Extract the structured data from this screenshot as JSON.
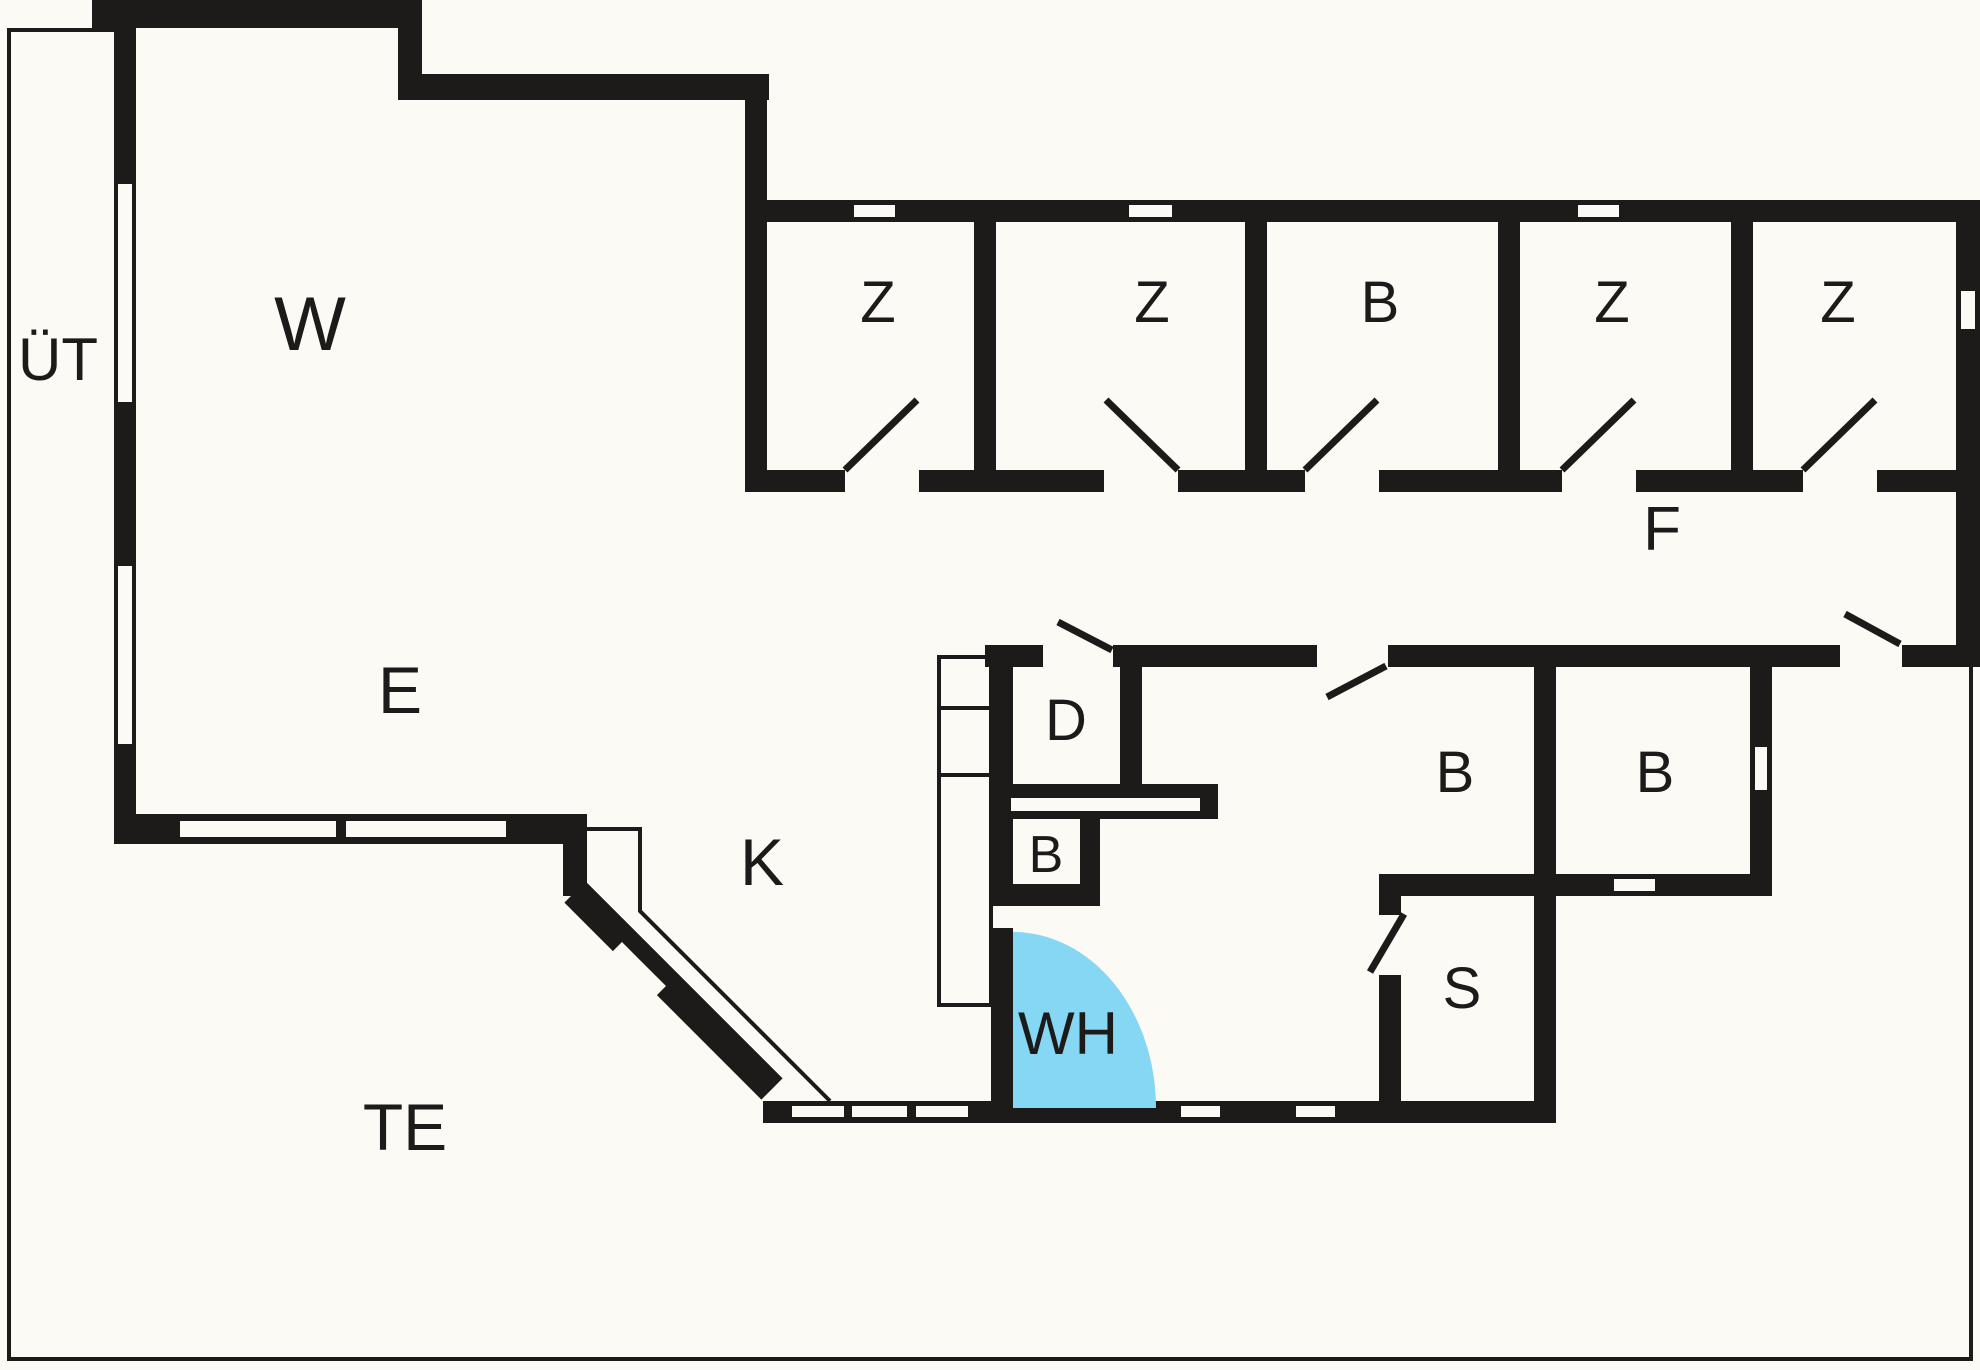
{
  "diagram": {
    "type": "floor-plan",
    "colors": {
      "wall": "#1d1b19",
      "background": "#fbfaf5",
      "window": "#fbfaf5",
      "door_swing_area": "#85d7f3"
    }
  },
  "rooms": {
    "ut": {
      "label": "ÜT"
    },
    "w": {
      "label": "W"
    },
    "e": {
      "label": "E"
    },
    "k": {
      "label": "K"
    },
    "te": {
      "label": "TE"
    },
    "f": {
      "label": "F"
    },
    "z1": {
      "label": "Z"
    },
    "z2": {
      "label": "Z"
    },
    "b_top": {
      "label": "B"
    },
    "z4": {
      "label": "Z"
    },
    "z5": {
      "label": "Z"
    },
    "d": {
      "label": "D"
    },
    "wc": {
      "label": "B"
    },
    "wh": {
      "label": "WH"
    },
    "b_left": {
      "label": "B"
    },
    "b_right": {
      "label": "B"
    },
    "s": {
      "label": "S"
    }
  }
}
